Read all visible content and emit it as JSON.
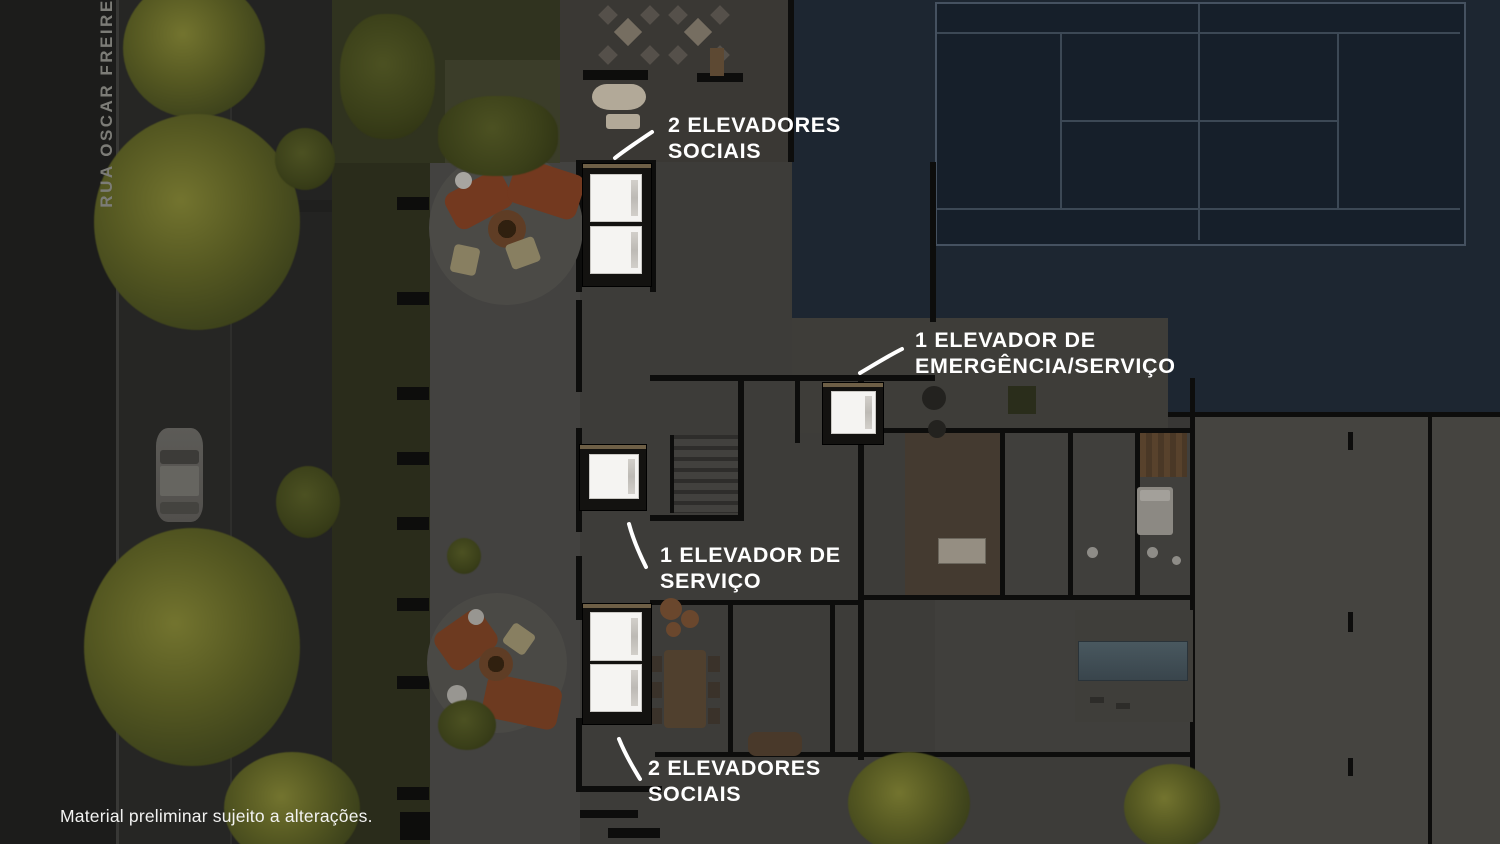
{
  "street_label": "RUA OSCAR FREIRE",
  "disclaimer": "Material preliminar sujeito a alterações.",
  "annotations": {
    "social_top": {
      "line1": "2 ELEVADORES",
      "line2": "SOCIAIS"
    },
    "emergency": {
      "line1": "1 ELEVADOR DE",
      "line2": "EMERGÊNCIA/SERVIÇO"
    },
    "service": {
      "line1": "1 ELEVADOR DE",
      "line2": "SERVIÇO"
    },
    "social_bottom": {
      "line1": "2 ELEVADORES",
      "line2": "SOCIAIS"
    }
  },
  "colors": {
    "annotation_text": "#ffffff",
    "leader_line": "#ffffff",
    "street_label_text": "#7c7c77",
    "disclaimer_text": "#f2f2f1",
    "elevator_highlight": "#f5f4f2",
    "water_navy": "#1d2631",
    "tennis_court_surface": "#161f2a",
    "tennis_court_line": "#3c4855",
    "foliage_olive": "#565922",
    "lounger_rust": "#73391f"
  }
}
